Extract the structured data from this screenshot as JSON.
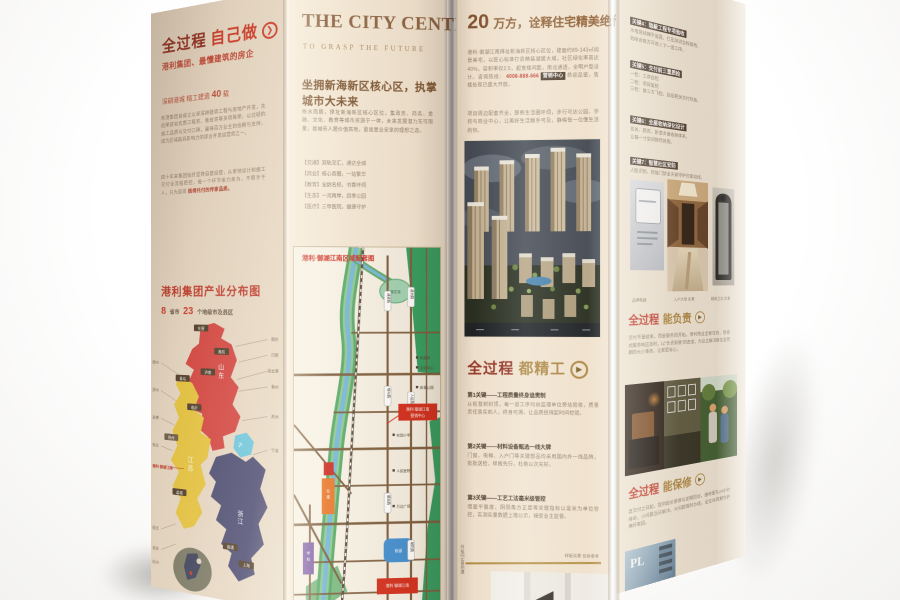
{
  "colors": {
    "paper": "#efe3d0",
    "accent_red": "#c0392b",
    "maroon": "#8f2b1e",
    "gold": "#a8823e",
    "brown_title": "#8a6140",
    "map_green": "#2f9e5f",
    "map_river": "#74b6d8"
  },
  "panelA": {
    "heading": "全过程",
    "heading_accent": "自己做",
    "subheading": "港利集团、最懂建筑的房企",
    "tagline_pre": "深耕港城 精工建造",
    "tagline_num": "40",
    "tagline_post": "载",
    "para1": "新港集团自成立以来深耕建筑工程与房地产开发，先后荣获省优质工程奖、鲁班奖等多项殊荣，以过硬的施工品质与交付口碑，赢得百万业主的信赖与支持，成为区域最具影响力的综合开发运营商之一。",
    "para2": "四十年来集团始终坚持自建自营，从拿地设计到施工交付全流程把控，每一个环节亲力亲为，不假手于人，只为呈现",
    "para2_red": "值得托付的传家品质。",
    "map_title": "港利集团产业分布图",
    "stat1_num": "8",
    "stat1_label": "省市",
    "stat2_num": "23",
    "stat2_label": "个地级市及县区",
    "provinces": {
      "n1": "山",
      "n2": "东",
      "w1": "江",
      "w2": "苏",
      "e1": "沪",
      "s1": "浙",
      "s2": "江"
    },
    "city_badges": [
      "东营",
      "潍坊",
      "济南",
      "青岛",
      "临沂",
      "徐州",
      "盐城",
      "南通",
      "上海"
    ],
    "left_labels": [
      "德州",
      "滨州",
      "淄博",
      "枣庄",
      "宿迁",
      "淮安",
      "杭州"
    ],
    "right_labels": [
      "烟台",
      "日照",
      "连云港",
      "泰州",
      "苏州",
      "宁波"
    ],
    "left_red_label": "港利·御湖江南"
  },
  "panelB": {
    "title": "THE CITY CENTER",
    "subtitle": "TO GRASP THE FUTURE",
    "headline": "坐拥新海新区核心区，执掌城市大未来",
    "para": "依水而居，择址新海新区核心区位，集政务、商务、金融、文化、教育等城市资源于一体，未来发展潜力无可限量，是城市人居价值高地，更是置业安家的理想之选。",
    "list0": "【交通】双轨交汇，通达全城",
    "list1": "【商业】核心商圈，一站繁华",
    "list2": "【教育】全龄名校，书香环伺",
    "list3": "【生态】一河两岸，四季公园",
    "list4": "【医疗】三甲医院，健康守护",
    "map": {
      "title": "港利·御湖江南区域配套图",
      "pond": "樱花湖",
      "lake": "映湖",
      "orange1": "在",
      "orange2": "建",
      "purple1": "学",
      "purple2": "校",
      "callout1a": "港利·御湖江南",
      "callout1b": "营销中心",
      "callout2": "港利·御湖江南",
      "road0": "通灌路",
      "road1": "瀛洲路",
      "road2": "郁州路",
      "road3": "人民路",
      "road4": "解放路",
      "road5": "朝阳路",
      "poi0": "市政府",
      "poi1": "文化中心",
      "poi2": "体育公园",
      "poi3": "实验小学",
      "poi4": "人民医院",
      "poi5": "万达广场"
    }
  },
  "panelC": {
    "headline_num": "20",
    "headline_rest": "万方，诠释住宅精美绝伦……",
    "para1a": "港利·御湖江南择址新海新区核心区位，建面约89-143㎡阔景美宅，以匠心标准打造精装湖居大城，社区绿化率高达40%，容积率仅2.5，超宽楼间距，南北通透，全明户型设计。咨询热线：",
    "para1_red": "4008-888-666",
    "para1_badge": "营销中心",
    "para1b": "恭迎品鉴，售楼处现已盛大开放。",
    "para2": "项目周边配套齐全，醇熟生活圈环伺，步行可达公园、学校与商业中心，让美好生活触手可及，静候每一位懂生活的你。",
    "heading_main": "全过程",
    "heading_accent": "都精工",
    "key0_h": "第1关键——工程质量终身追责制",
    "key0_p": "从桩基到封顶，每一道工序均由监理单位旁站验收，质量责任落实到人，终身可溯，让品质经得起时间检验。",
    "key1_h": "第2关键——材料设备甄选一线大牌",
    "key1_p": "门窗、电梯、入户门等关键部品均采用国内外一线品牌，批批送检，样板先行，杜绝以次充好。",
    "key2_h": "第3关键——工艺工法毫米级管控",
    "key2_p": "墙面平整度、阴阳角方正度等关键指标以毫米为单位管控，实测实量数据上墙公示，接受业主监督。",
    "caption_left": "样板间实景拍摄",
    "caption_right": "样板实景  仅供参考"
  },
  "panelD": {
    "g0_h": "关键4：隐蔽工程专项验收",
    "g0_l0": "水电管线横平竖直，打压测试全程留档，",
    "g0_l1": "验收合格方可进入下一道工序。",
    "g1_h": "关键5：交付前三重质检",
    "g1_l0": "一检：工序自检",
    "g1_l1": "二检：项目复检",
    "g1_l2": "三检：第三方飞检，层层把关交付标准。",
    "g2_h": "关键6：全屋收纳深化设计",
    "g2_l0": "玄关、厨房、卧室多维收纳体系，",
    "g2_l1": "让每一寸空间物尽其用。",
    "g3_h": "关键7：智慧社区安防",
    "g3_l0": "人脸识别、智能门禁全天候守护归家动线。",
    "cap0": "品牌电器",
    "cap1": "入户大堂 实景",
    "cap2": "精装卫浴 实景",
    "heading1_main": "全过程",
    "heading1_accent": "能负责",
    "para1": "交付不是结束，而是服务的开始。港利物业全程在线，管家式服务响应及时，以“负责到底”的态度，为业主解决居住全周期的大小事务，让家更省心。",
    "heading2_main": "全过程",
    "heading2_accent": "能保修",
    "para2": "自交付之日起，提供超长质保与定期回访，维修团队24小时待命，小问题当日解决，大问题限时办结，全生命周期守护美好家园。",
    "photo_letters": "PL"
  }
}
